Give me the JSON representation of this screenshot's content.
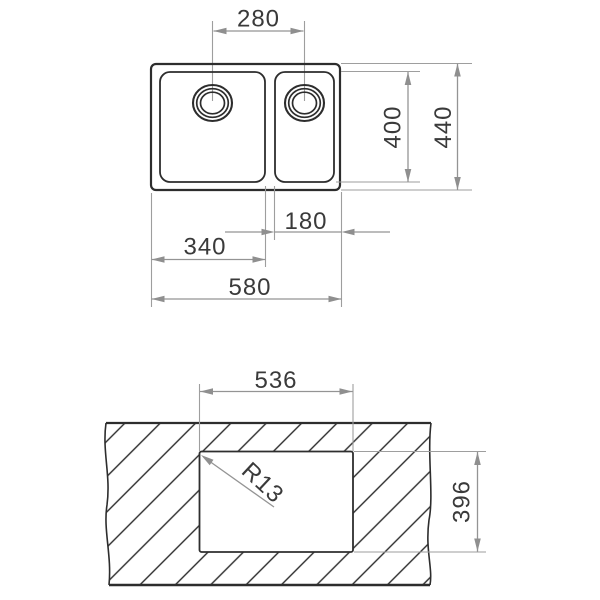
{
  "page": {
    "background": "#ffffff"
  },
  "drawing": {
    "type": "sink-installation-dimension-diagram",
    "colors": {
      "outline": "#2d2d2d",
      "dimension_gray": "#949494",
      "label_text": "#3a3a3a",
      "background": "#ffffff"
    },
    "plan_view": {
      "name": "sink-plan-view",
      "dimensions": {
        "drain_spacing": "280",
        "bowl_depth": "400",
        "overall_depth": "440",
        "right_bowl_width": "180",
        "left_bowl_width": "340",
        "overall_width": "580"
      }
    },
    "cutout_view": {
      "name": "worktop-cutout-view",
      "dimensions": {
        "cutout_width": "536",
        "cutout_height": "396",
        "corner_radius": "R13"
      }
    }
  }
}
